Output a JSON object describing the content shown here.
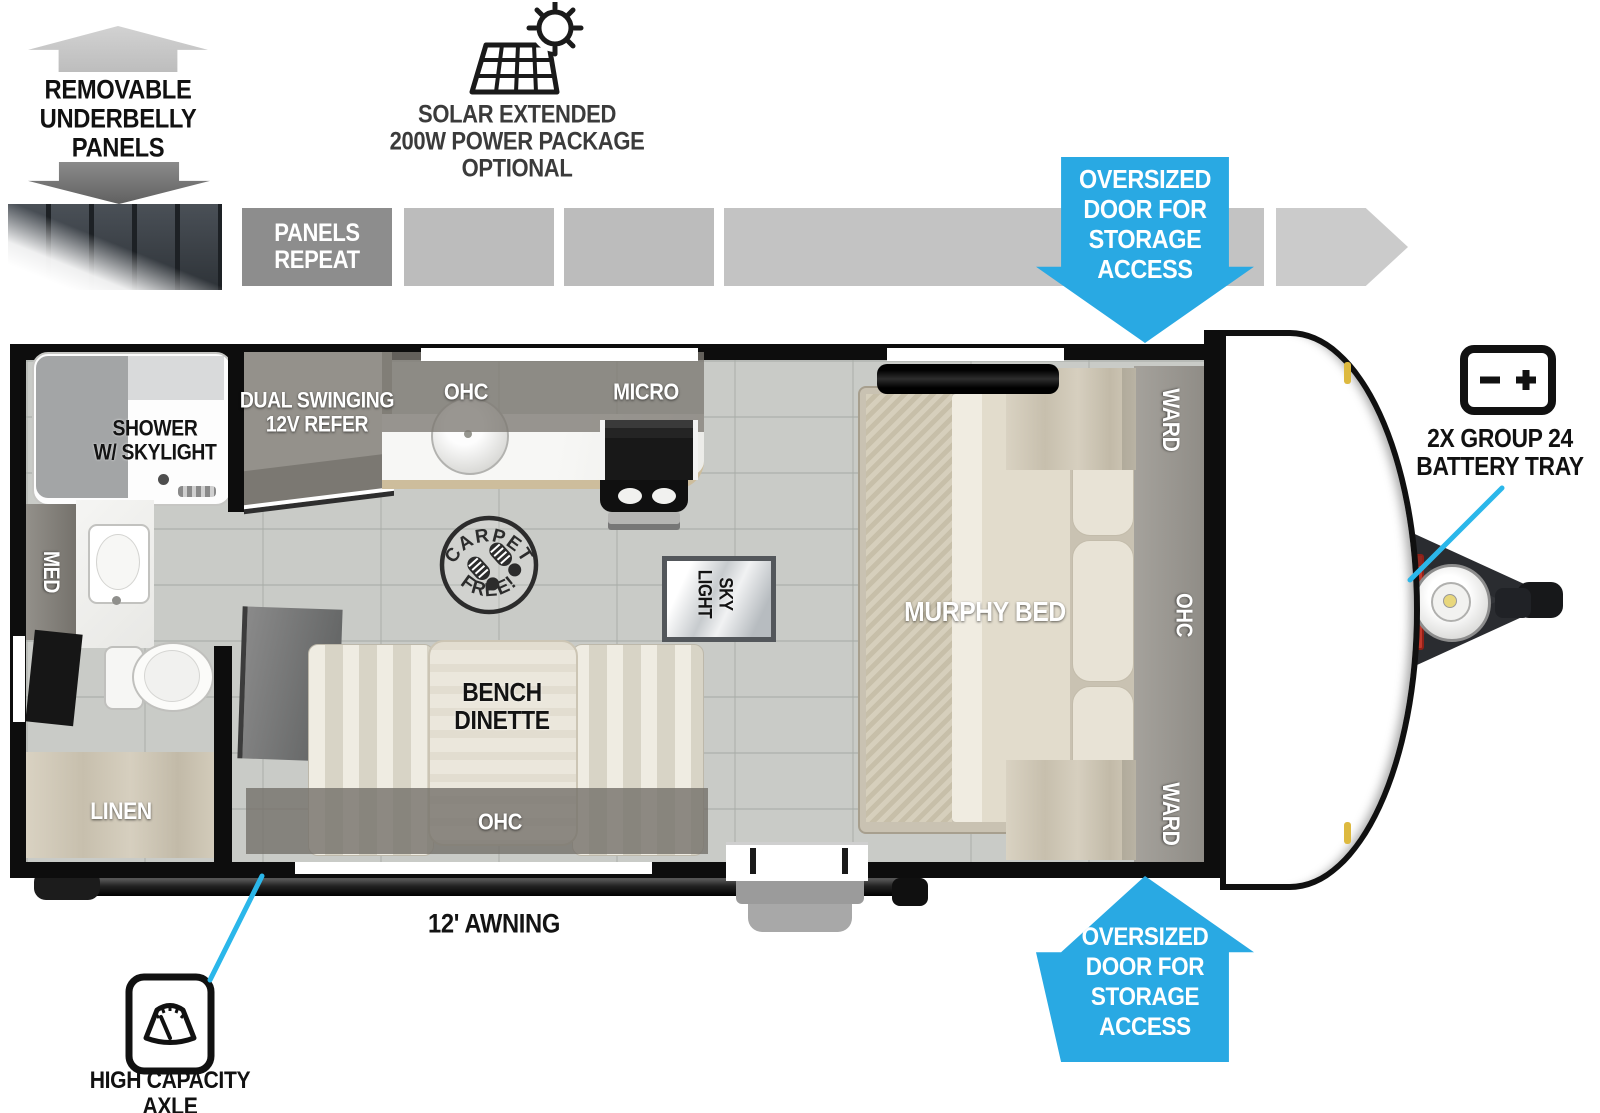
{
  "callouts": {
    "underbelly": "REMOVABLE\nUNDERBELLY\nPANELS",
    "panels_repeat": "PANELS\nREPEAT",
    "solar": "SOLAR EXTENDED\n200W POWER PACKAGE\nOPTIONAL",
    "oversized_door_top": "OVERSIZED\nDOOR FOR\nSTORAGE\nACCESS",
    "oversized_door_bottom": "OVERSIZED\nDOOR FOR\nSTORAGE\nACCESS",
    "battery_tray": "2X GROUP 24\nBATTERY TRAY",
    "awning": "12' AWNING",
    "axle": "HIGH CAPACITY\nAXLE"
  },
  "rooms": {
    "shower": "SHOWER\nW/ SKYLIGHT",
    "med": "MED",
    "linen": "LINEN",
    "refer": "DUAL SWINGING\n12V REFER",
    "kitchen_ohc": "OHC",
    "micro": "MICRO",
    "dinette": "BENCH\nDINETTE",
    "dinette_ohc": "OHC",
    "skylight": "SKY\nLIGHT",
    "murphy_bed": "MURPHY BED",
    "ward_top": "WARD",
    "ward_bottom": "WARD",
    "bed_ohc": "OHC",
    "carpet_free_top": "CARPET",
    "carpet_free_bottom": "FREE!"
  },
  "colors": {
    "accent_blue": "#29a9e3",
    "callout_cyan": "#2bb7ea",
    "wall_black": "#0d0d0d"
  },
  "icons": {
    "solar": "solar-panel-sun-icon",
    "battery": "battery-terminals-icon",
    "axle": "weight-scale-icon",
    "underbelly_up": "block-arrow-up-icon",
    "underbelly_down": "block-arrow-down-icon"
  }
}
